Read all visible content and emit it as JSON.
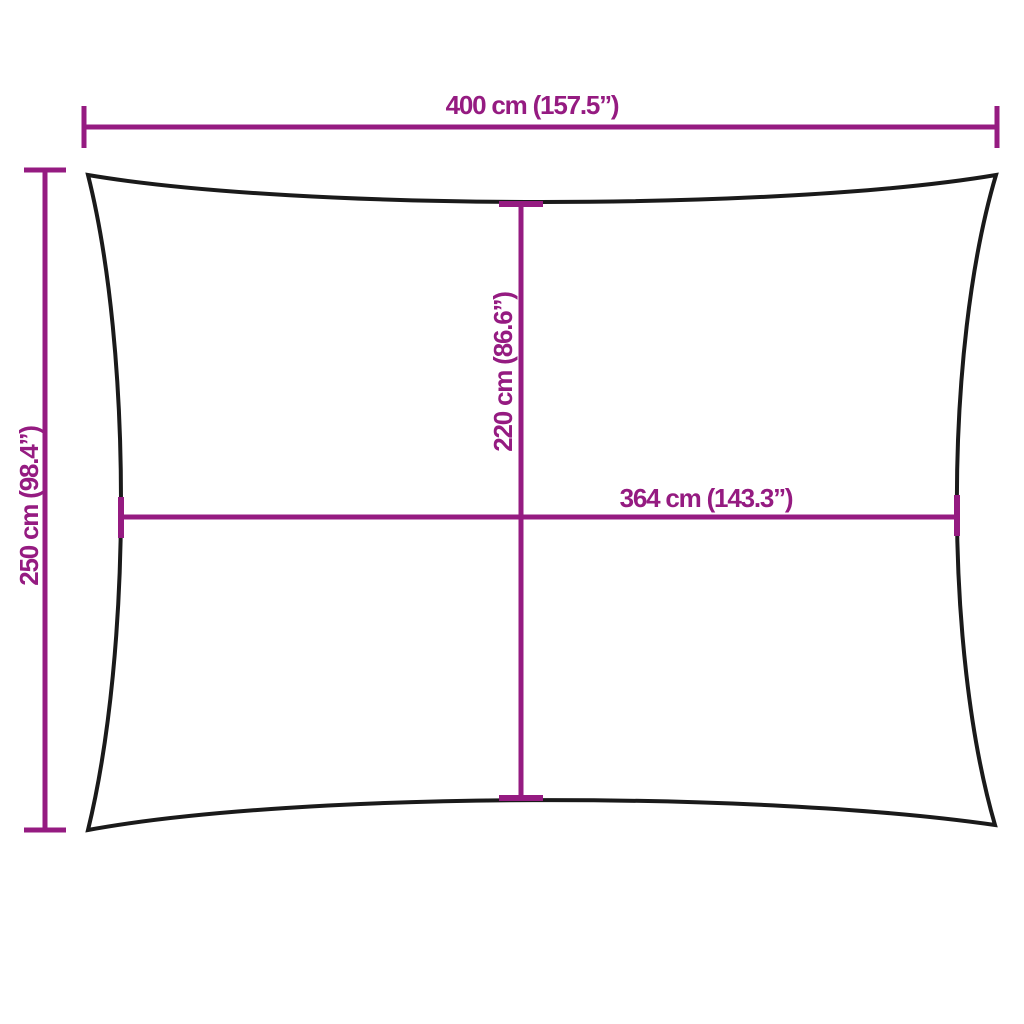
{
  "colors": {
    "accent": "#951b81",
    "outline": "#1a1a1a",
    "background": "#ffffff"
  },
  "measurements": {
    "outer_width": {
      "label": "400 cm (157.5”)",
      "cm": 400,
      "inches": 157.5
    },
    "outer_height": {
      "label": "250 cm (98.4”)",
      "cm": 250,
      "inches": 98.4
    },
    "inner_height": {
      "label": "220 cm (86.6”)",
      "cm": 220,
      "inches": 86.6
    },
    "inner_width": {
      "label": "364 cm (143.3”)",
      "cm": 364,
      "inches": 143.3
    }
  }
}
